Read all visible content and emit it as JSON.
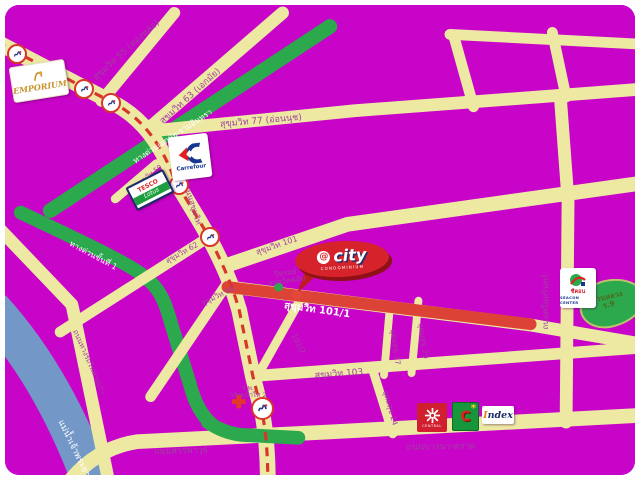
{
  "map_title": "Bangkok Sukhumvit area location map",
  "colors": {
    "background_magenta": "#C704C7",
    "road_yellow": "#EDE9A3",
    "road_label_purple": "#A041A0",
    "expressway_green": "#2CA94D",
    "river_blue": "#7398C8",
    "transit_line_red": "#D8362B",
    "highlight_road_red": "#DD4237",
    "bubble_red": "#D6232B"
  },
  "labels": {
    "sukhumvit55": "สุขุมวิท 55 (ทองหล่อ)",
    "sukhumvit63": "สุขุมวิท 63 (เอกมัย)",
    "expressway_ekamai_ramindra": "ทางด่วนเอกมัย-รามอินทรา",
    "sukhumvit77": "สุขุมวิท 77 (อ่อนนุช)",
    "thanon_sukhumvit": "ถนนสุขุมวิท",
    "sukhumvit50": "สุขุมวิท 50",
    "sukhumvit62": "สุขุมวิท 62",
    "sukhumvit64": "สุขุมวิท 64",
    "sukhumvit101": "สุขุมวิท 101",
    "expressway_stage1": "ทางด่วนขั้นที่ 1",
    "sukhumvit101_1": "สุขุมวิท 101/1",
    "sukhumvit103": "สุขุมวิท 103",
    "udomsuk27": "อุดมสุข 27",
    "udomsuk29": "อุดมสุข 29",
    "soi101_2": "101/2",
    "udomsuk24": "อุดมสุข 24",
    "srinagarindra": "ถนนศรีนครินทร์",
    "sanphawut": "ถนนสรรพาวุธ",
    "bangna_trad": "ถนนบางนา-ตราด",
    "old_railway_road": "ถนนทางรถไฟสายเก่า",
    "chao_phraya_river": "แม่น้ำเจ้าพระยา",
    "piyarom_1": "ปิยรมย์",
    "piyarom_2": "สปอร์ตคลับ",
    "hospital_1": "ร.พ.",
    "hospital_2": "กล้วยน้ำไท 2",
    "park_1": "สวนหลวง",
    "park_2": "ร.9"
  },
  "logos": {
    "emporium": "EMPORIUM",
    "tesco_top": "TESCO",
    "tesco_bottom": "Lotus",
    "carrefour": "Carrefour",
    "atcity_at": "@",
    "atcity_name": "city",
    "atcity_tagline": "CONDOMINIUM",
    "seacon_thai": "ซีคอน",
    "seacon_en": "SEACON CENTER",
    "central": "CENTRAL",
    "bigc": "C",
    "index": "Index"
  }
}
